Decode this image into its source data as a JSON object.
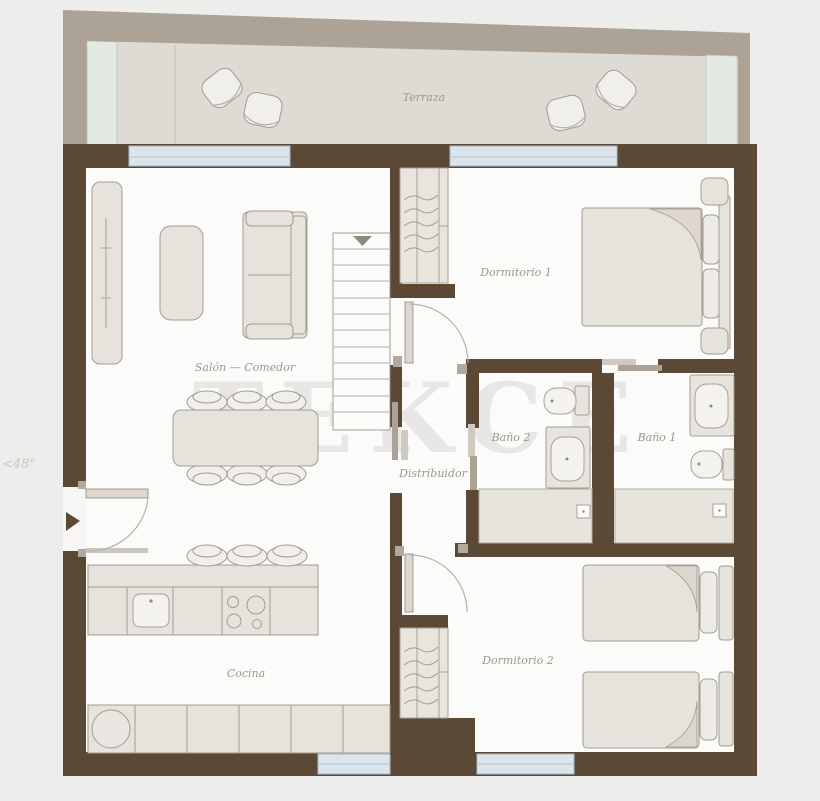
{
  "plan": {
    "title": "Apartment floor plan",
    "watermark": "TEKCE",
    "watermark_fragment": "<48°",
    "rooms": [
      {
        "id": "terraza",
        "label": "Terraza"
      },
      {
        "id": "salon",
        "label": "Salón — Comedor"
      },
      {
        "id": "dormitorio1",
        "label": "Dormitorio 1"
      },
      {
        "id": "bano2",
        "label": "Baño 2"
      },
      {
        "id": "bano1",
        "label": "Baño 1"
      },
      {
        "id": "distribuidor",
        "label": "Distribuidor"
      },
      {
        "id": "cocina",
        "label": "Cocina"
      },
      {
        "id": "dormitorio2",
        "label": "Dormitorio 2"
      }
    ],
    "colors": {
      "background": "#edeeeb",
      "wall": "#5b4936",
      "terrace_band": "#aca295",
      "terrace_floor": "#dedad4",
      "glass_panel": "#e3eae2",
      "window": "#dce4ec",
      "floor": "#fbfbfa",
      "furniture": "#e6e2dc",
      "furniture_stroke": "#a49c90",
      "label_text": "#9f978d",
      "watermark": "#a8a59f",
      "door_leaf": "#dcd7cf",
      "sliding_bar": "#aaa296"
    }
  }
}
